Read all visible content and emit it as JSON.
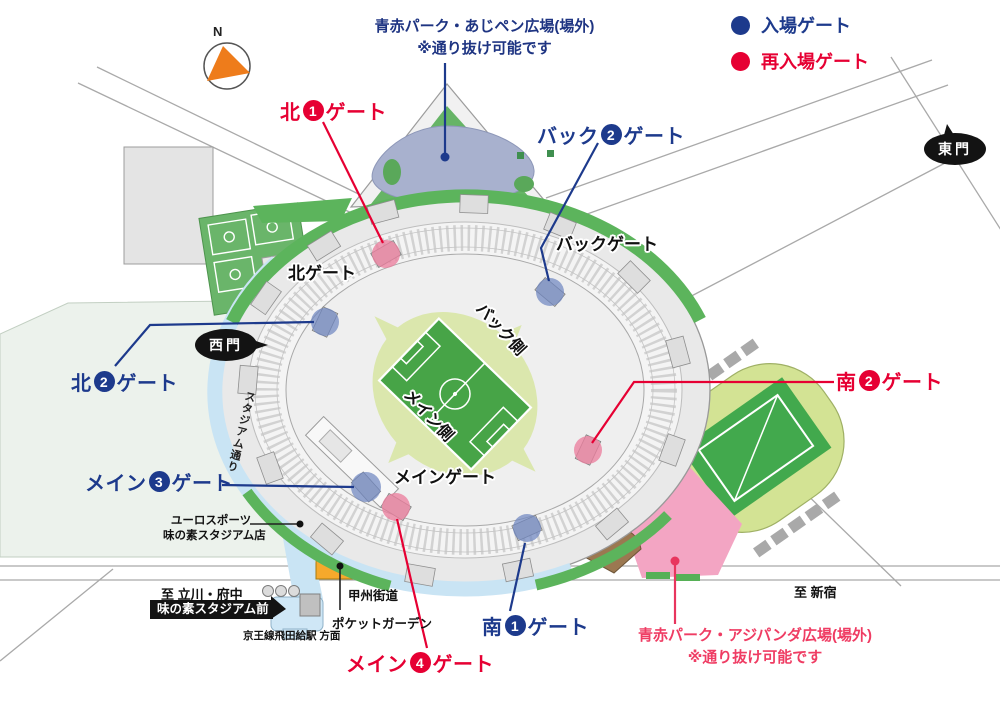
{
  "colors": {
    "entry_blue": "#1d3a8c",
    "reentry_red": "#e60033",
    "park_note_navy": "#1e3482",
    "park_note_pink": "#ef3c63",
    "pitch_green": "#47a447",
    "plaza_pink": "#f3a5c3"
  },
  "compass": {
    "north": "N"
  },
  "legend": {
    "entry_label": "入場ゲート",
    "reentry_label": "再入場ゲート"
  },
  "park_north": {
    "line1": "青赤パーク・あじペン広場(場外)",
    "line2": "※通り抜け可能です"
  },
  "park_south": {
    "line1": "青赤パーク・アジパンダ広場(場外)",
    "line2": "※通り抜け可能です"
  },
  "gate_labels": {
    "kita1": {
      "pre": "北",
      "num": "1",
      "post": "ゲート",
      "type": "reentry"
    },
    "back2": {
      "pre": "バック",
      "num": "2",
      "post": "ゲート",
      "type": "entry"
    },
    "kita2": {
      "pre": "北",
      "num": "2",
      "post": "ゲート",
      "type": "entry"
    },
    "minami2": {
      "pre": "南",
      "num": "2",
      "post": "ゲート",
      "type": "reentry"
    },
    "main3": {
      "pre": "メイン",
      "num": "3",
      "post": "ゲート",
      "type": "entry"
    },
    "minami1": {
      "pre": "南",
      "num": "1",
      "post": "ゲート",
      "type": "entry"
    },
    "main4": {
      "pre": "メイン",
      "num": "4",
      "post": "ゲート",
      "type": "reentry"
    }
  },
  "map_labels": {
    "kita_gate": "北ゲート",
    "back_gate": "バックゲート",
    "main_gate": "メインゲート",
    "nishimon": "西門",
    "tomon": "東門",
    "stadium_street": "スタジアム通り",
    "back_side": "バック側",
    "main_side": "メイン側",
    "eurosport_line1": "ユーロスポーツ",
    "eurosport_line2": "味の素スタジアム店",
    "to_tachikawa": "至 立川・府中",
    "to_shinjuku": "至 新宿",
    "bus_stop": "味の素スタジアム前",
    "keio_station": "京王線飛田給駅 方面",
    "koshu_kaido": "甲州街道",
    "pocket_garden": "ポケットガーデン"
  }
}
